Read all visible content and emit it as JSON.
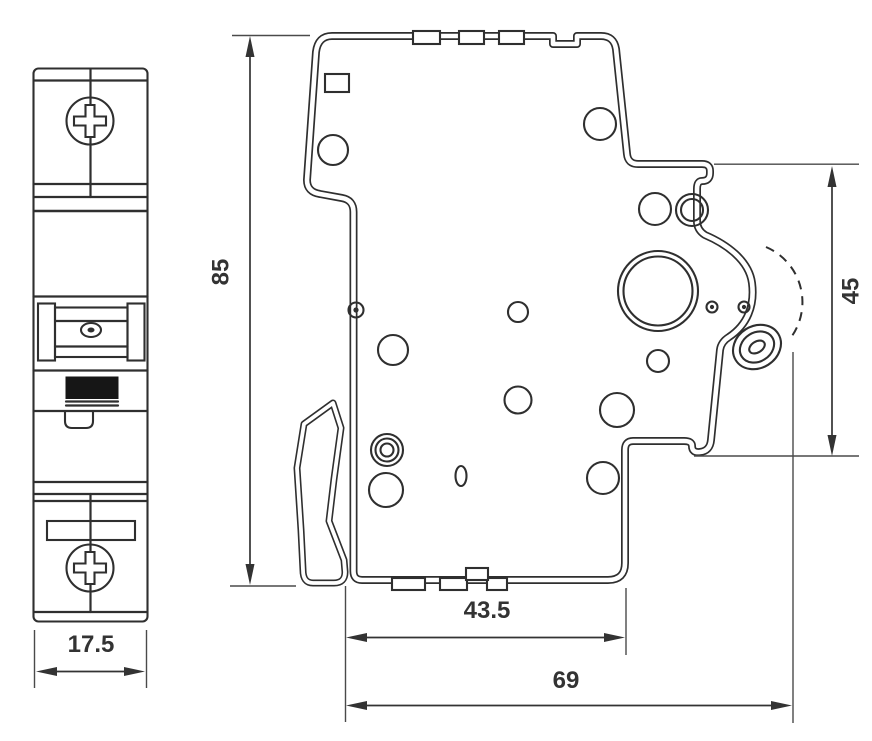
{
  "drawing": {
    "kind": "technical-dimension-drawing",
    "subject": "din-rail-miniature-circuit-breaker",
    "colors": {
      "line": "#2f2f2f",
      "thin_line": "#4a4a4a",
      "text": "#333333",
      "toggle_fill": "#161616",
      "background": "#ffffff"
    },
    "dimensions": {
      "front_width": {
        "value": "17.5",
        "orientation": "horizontal",
        "view": "front"
      },
      "overall_height": {
        "value": "85",
        "orientation": "vertical",
        "view": "side"
      },
      "din_rail_recess": {
        "value": "45",
        "orientation": "vertical",
        "view": "side"
      },
      "body_depth": {
        "value": "43.5",
        "orientation": "horizontal",
        "view": "side"
      },
      "overall_depth": {
        "value": "69",
        "orientation": "horizontal",
        "view": "side"
      }
    }
  }
}
